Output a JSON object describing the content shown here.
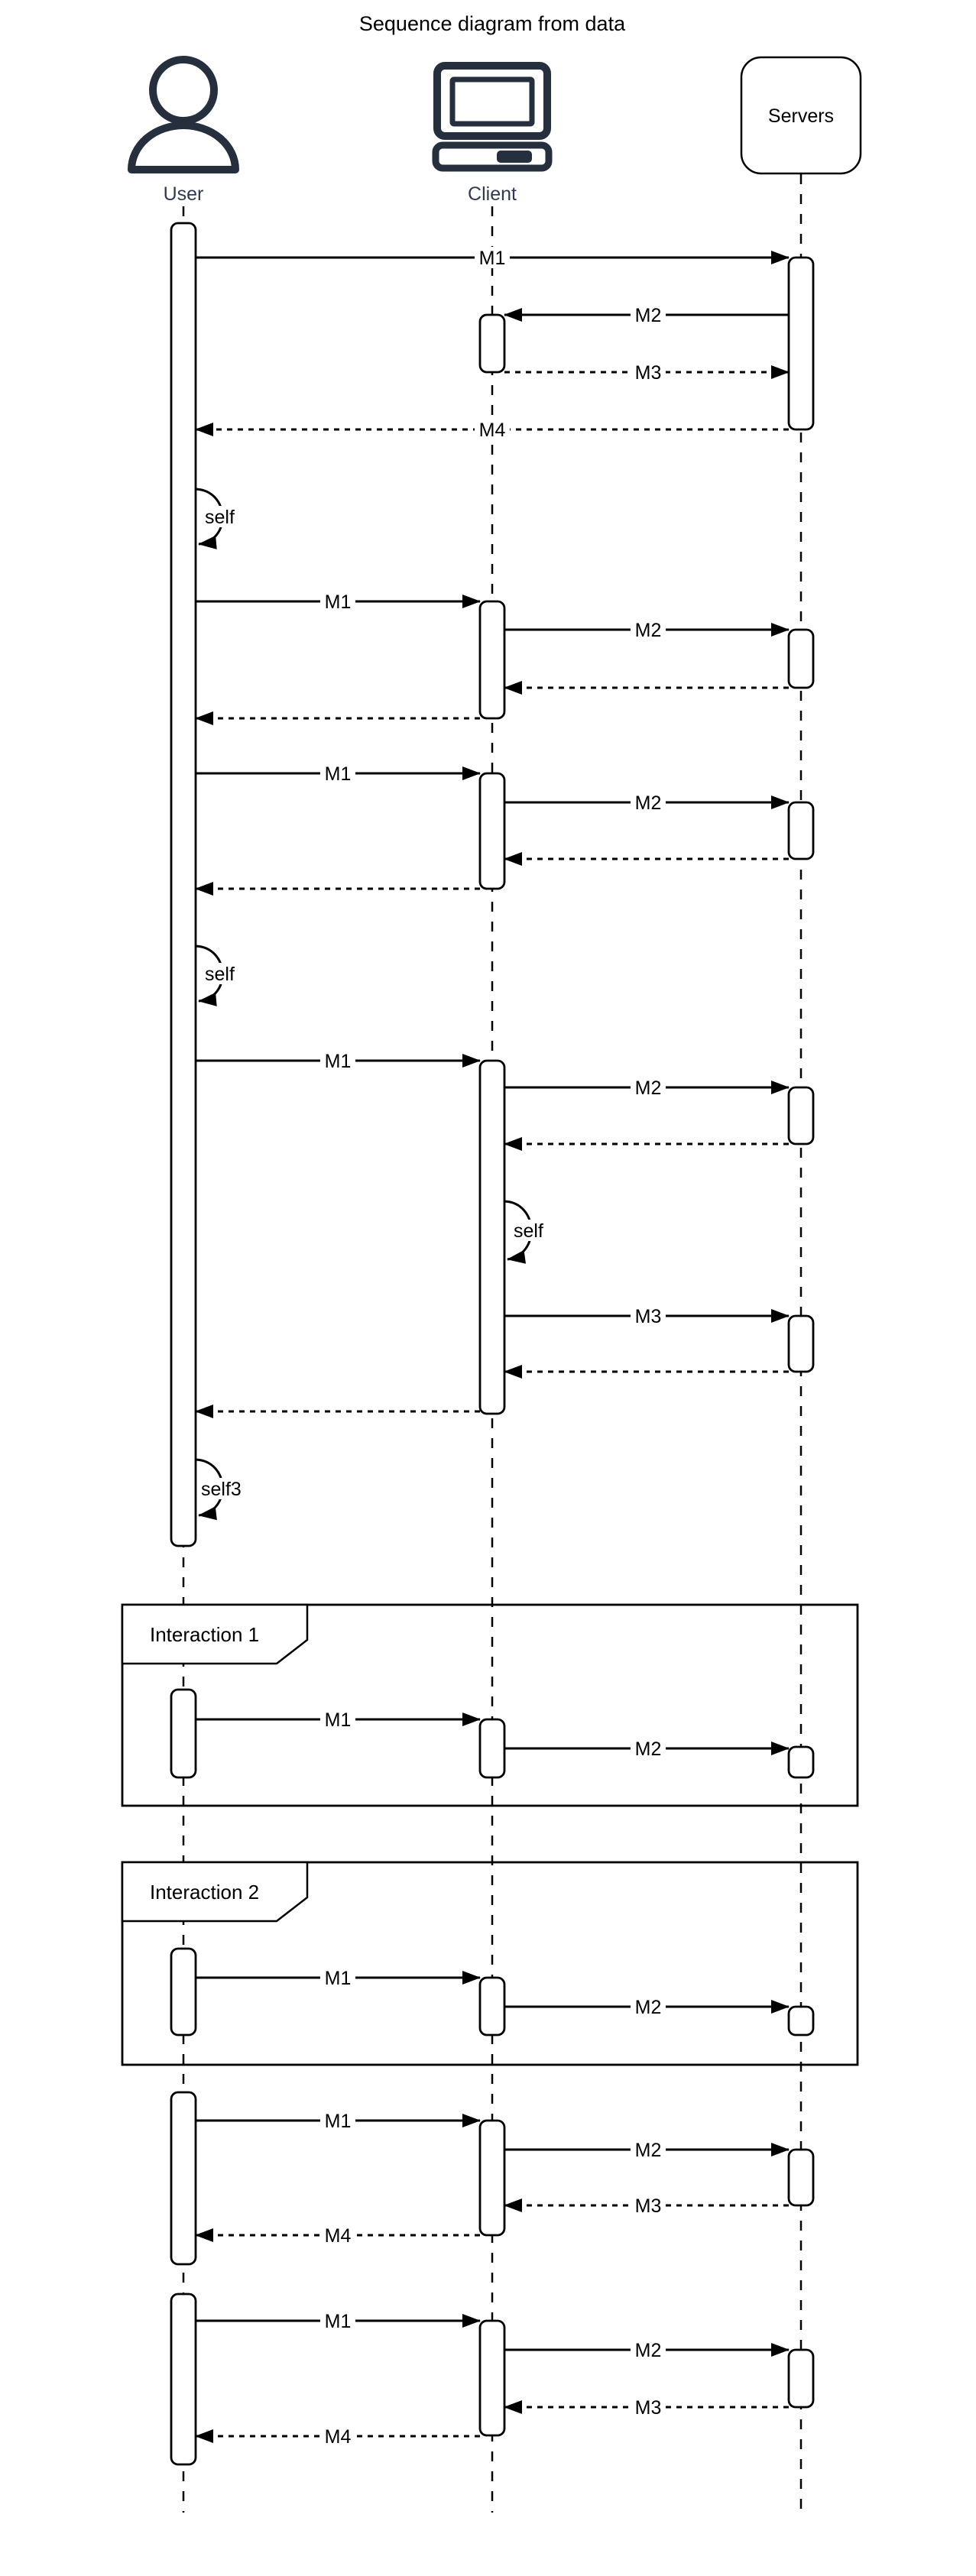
{
  "title": "Sequence diagram from data",
  "actors": {
    "user": {
      "label": "User"
    },
    "client": {
      "label": "Client"
    },
    "servers": {
      "label": "Servers"
    }
  },
  "colors": {
    "line": "#000000",
    "actor_icon": "#262F3D",
    "actor_label": "#2F3B52",
    "background": "#ffffff"
  },
  "blocks": {
    "block_a": {
      "m1": "M1",
      "m2": "M2",
      "m3": "M3",
      "m4": "M4"
    },
    "self_loop_1": {
      "label": "self"
    },
    "block_b": {
      "m1": "M1",
      "m2": "M2"
    },
    "block_c": {
      "m1": "M1",
      "m2": "M2"
    },
    "self_loop_2": {
      "label": "self"
    },
    "block_d": {
      "m1": "M1",
      "m2": "M2",
      "self_label": "self",
      "m3": "M3"
    },
    "self_loop_3": {
      "label": "self3"
    },
    "frame_1": {
      "title": "Interaction 1",
      "m1": "M1",
      "m2": "M2"
    },
    "frame_2": {
      "title": "Interaction 2",
      "m1": "M1",
      "m2": "M2"
    },
    "block_e": {
      "m1": "M1",
      "m2": "M2",
      "m3": "M3",
      "m4": "M4"
    },
    "block_f": {
      "m1": "M1",
      "m2": "M2",
      "m3": "M3",
      "m4": "M4"
    }
  }
}
